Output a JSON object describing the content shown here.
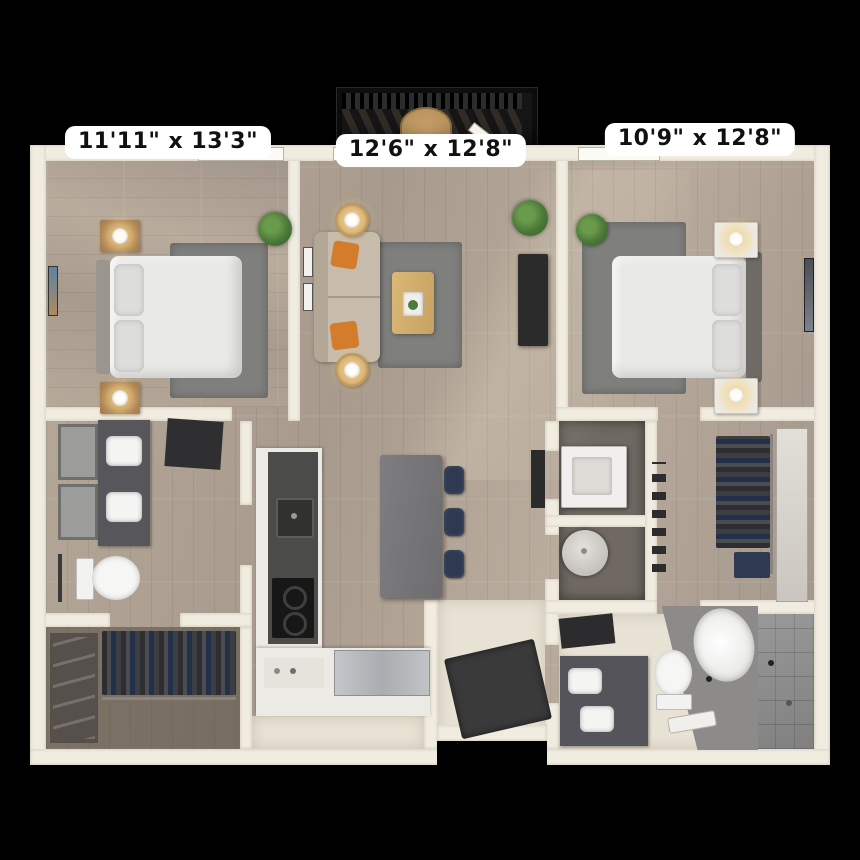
{
  "scene": {
    "type": "3d-floor-plan",
    "description": "Top-down 3D rendered two-bedroom apartment floor plan on black background with balcony at top center"
  },
  "labels": {
    "bedroom1": "11'11\" x 13'3\"",
    "living": "12'6\" x 12'8\"",
    "bedroom2": "10'9\" x 12'8\""
  },
  "palette": {
    "bg": "#000000",
    "wall": "#f1ece0",
    "walledge": "#cfc8b8",
    "wood": "#b2a496",
    "wood2": "#a3968a",
    "cream": "#e8e2d4",
    "rug": "#7f7f7d",
    "island": "#76767a",
    "counter": "#4b4b49",
    "cabinet": "#eceae4",
    "stainless": "#b9bdc0",
    "sofa": "#c7bcab",
    "orange": "#d27c2c",
    "navy": "#2d3a52",
    "tile": "#8f8f8f",
    "plant": "#4c7a38",
    "whitefurn": "#ecebe8",
    "darkpanel": "#2b2b2c",
    "labelbg": "#ffffff",
    "labeltext": "#111111",
    "balcony": "#161616",
    "tabletan": "#c59a63",
    "woodfloordark": "#6f6962"
  }
}
